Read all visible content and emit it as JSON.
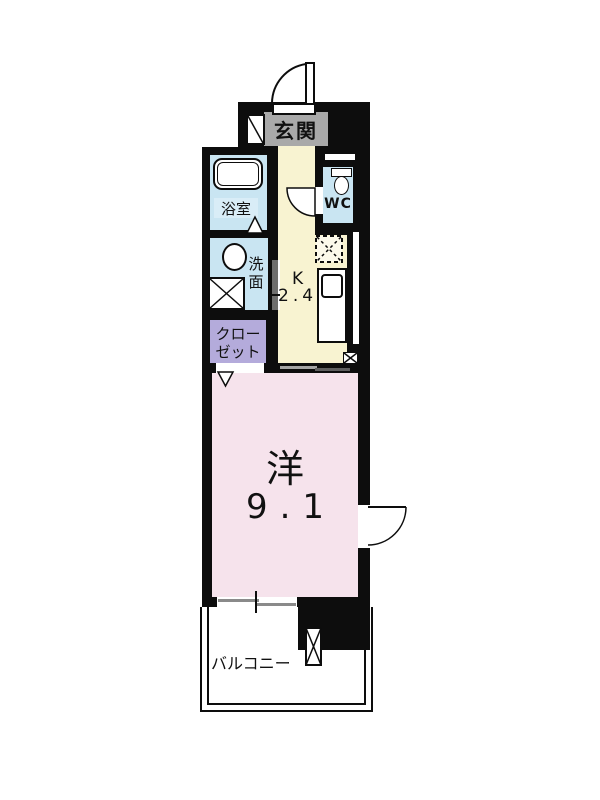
{
  "plan": {
    "entrance": {
      "label": "玄関"
    },
    "bathroom": {
      "label": "浴室"
    },
    "washroom": {
      "chars": [
        "洗",
        "面"
      ]
    },
    "toilet": {
      "label": "WC"
    },
    "closet": {
      "lines": [
        "クロー",
        "ゼット"
      ]
    },
    "kitchen": {
      "type_label": "K",
      "size_label": "2.4"
    },
    "main_room": {
      "type_label": "洋",
      "size_label": "9.1"
    },
    "balcony": {
      "label": "バルコニー"
    },
    "colors": {
      "wall": "#0d0d0d",
      "hall_floor": "#f8f3d1",
      "wet_floor": "#c9e5f2",
      "closet_floor": "#b4abdb",
      "room_floor": "#f6e3ec",
      "entrance_label_bg": "#a9a9a9"
    }
  }
}
